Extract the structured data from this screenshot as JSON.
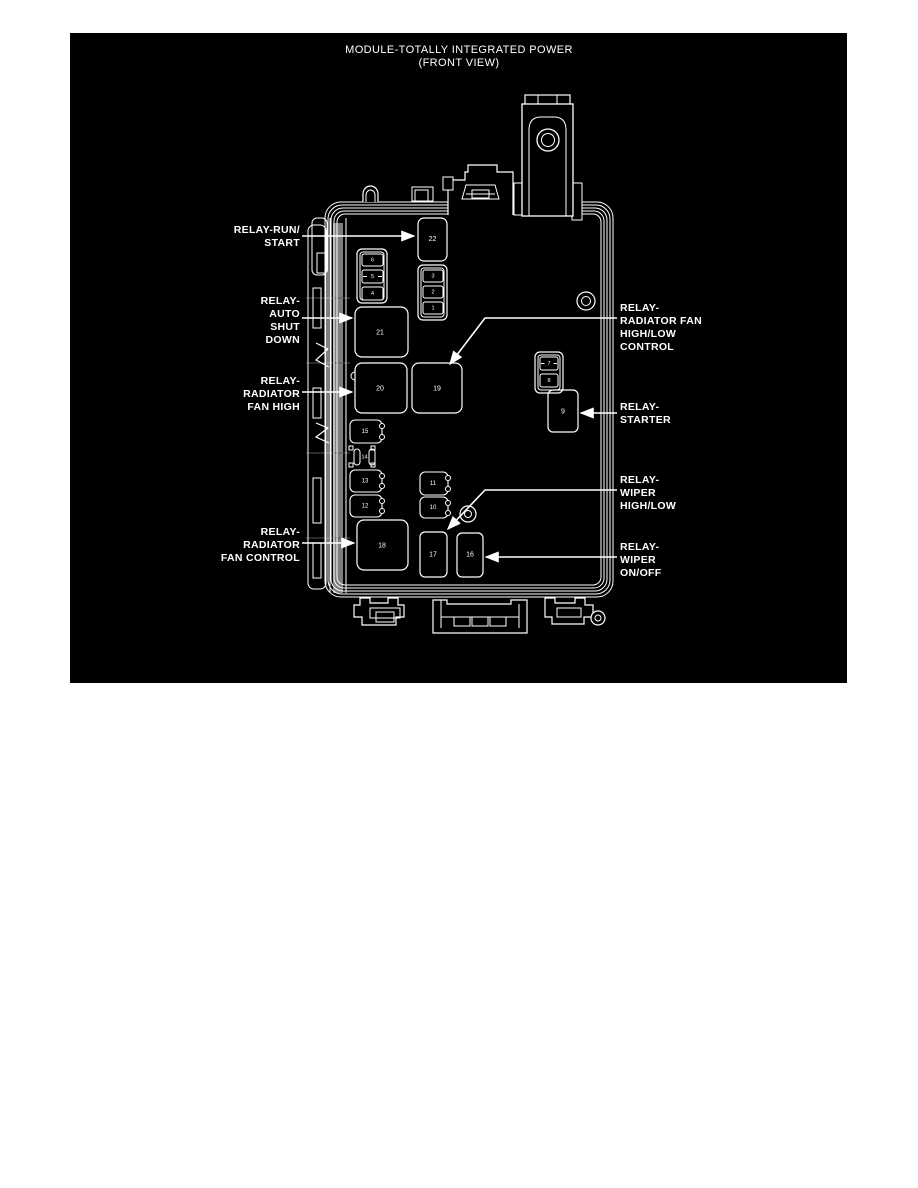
{
  "title": {
    "line1": "MODULE-TOTALLY INTEGRATED POWER",
    "line2": "(FRONT VIEW)"
  },
  "colors": {
    "canvas_background": "#000000",
    "line": "#ffffff",
    "page_background": "#ffffff",
    "rail_gray": "#7d7d7d"
  },
  "callouts": {
    "left": [
      {
        "id": "relay-run-start",
        "lines": [
          "RELAY-RUN/",
          "START"
        ]
      },
      {
        "id": "relay-auto-shut-down",
        "lines": [
          "RELAY-",
          "AUTO",
          "SHUT",
          "DOWN"
        ]
      },
      {
        "id": "relay-radiator-fan-high",
        "lines": [
          "RELAY-",
          "RADIATOR",
          "FAN HIGH"
        ]
      },
      {
        "id": "relay-radiator-fan-control",
        "lines": [
          "RELAY-",
          "RADIATOR",
          "FAN CONTROL"
        ]
      }
    ],
    "right": [
      {
        "id": "relay-radiator-fan-high-low-control",
        "lines": [
          "RELAY-",
          "RADIATOR FAN",
          "HIGH/LOW",
          "CONTROL"
        ]
      },
      {
        "id": "relay-starter",
        "lines": [
          "RELAY-",
          "STARTER"
        ]
      },
      {
        "id": "relay-wiper-high-low",
        "lines": [
          "RELAY-",
          "WIPER",
          "HIGH/LOW"
        ]
      },
      {
        "id": "relay-wiper-on-off",
        "lines": [
          "RELAY-",
          "WIPER",
          "ON/OFF"
        ]
      }
    ]
  },
  "cavities": {
    "relays": {
      "r9": "9",
      "r16": "16",
      "r17": "17",
      "r18": "18",
      "r19": "19",
      "r20": "20",
      "r21": "21",
      "r22": "22"
    },
    "micro": {
      "r10": "10",
      "r11": "11",
      "r12": "12",
      "r13": "13",
      "r15": "15"
    },
    "fuses": {
      "f1": "1",
      "f2": "2",
      "f3": "3",
      "f4": "4",
      "f5": "5",
      "f6": "6",
      "f7": "7",
      "f8": "8",
      "f14": "14"
    }
  }
}
